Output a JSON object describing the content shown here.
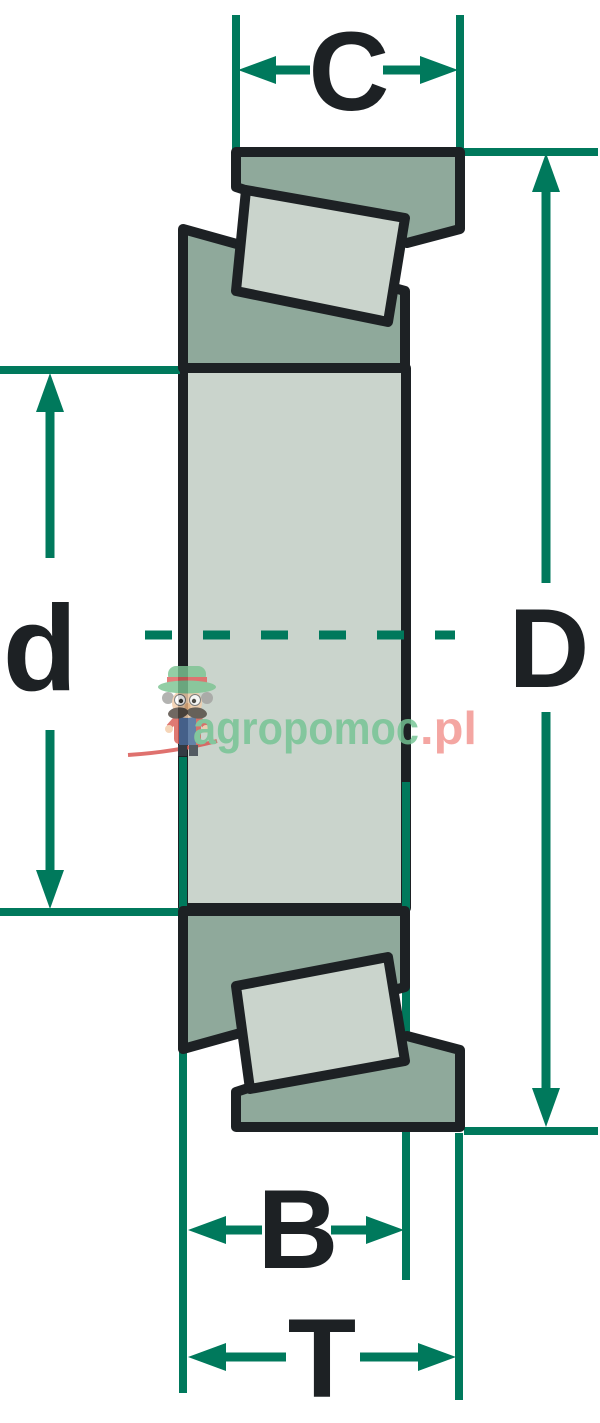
{
  "diagram": {
    "kind": "tapered-roller-bearing-cross-section",
    "dimensions": {
      "cup_width": {
        "label": "C"
      },
      "outer_diameter": {
        "label": "D"
      },
      "bore_diameter": {
        "label": "d"
      },
      "cone_width": {
        "label": "B"
      },
      "total_width": {
        "label": "T"
      }
    }
  },
  "watermark": {
    "brand_primary": "agropomoc",
    "brand_suffix": ".pl",
    "mascot_icon": "farmer-mascot"
  },
  "colors": {
    "dimension_green": "#00795c",
    "ring_fill_dark": "#8fa99b",
    "ring_fill_light": "#cad4cc",
    "outline_black": "#1d2124",
    "watermark_green": "#74c493",
    "watermark_red": "#f2938e",
    "watermark_swoosh_red": "#d9534f",
    "background": "#ffffff"
  }
}
